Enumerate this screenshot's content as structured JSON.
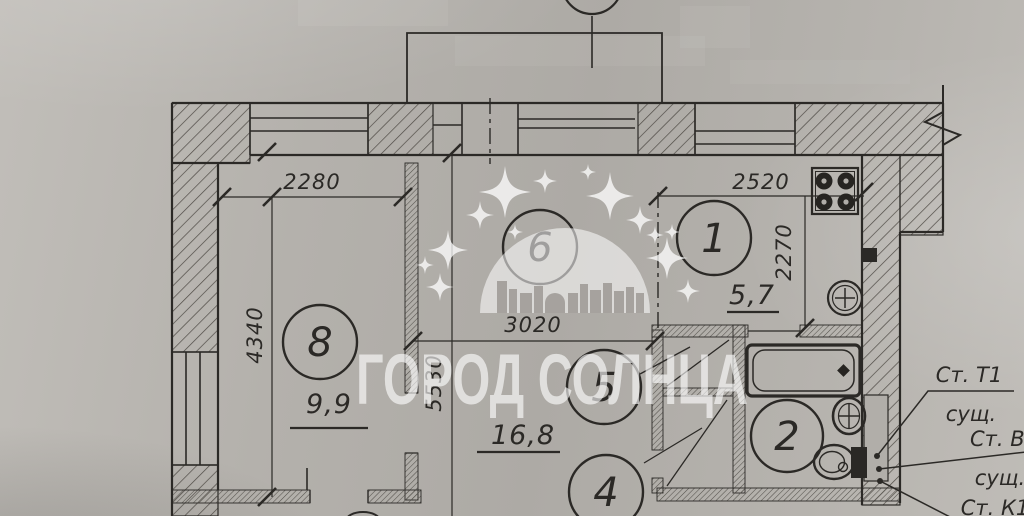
{
  "watermark": {
    "text": "ГОРОД СОЛНЦА"
  },
  "rooms": {
    "r1": "1",
    "r2": "2",
    "r4": "4",
    "r5": "5",
    "r6": "6",
    "r8": "8"
  },
  "areas": {
    "kitchen": "5,7",
    "room8": "9,9",
    "living": "16,8"
  },
  "dims": {
    "w2280": "2280",
    "w2520": "2520",
    "w3020": "3020",
    "h4340": "4340",
    "h5530": "5530",
    "h2270": "2270"
  },
  "risers": [
    {
      "label": "Ст. Т1",
      "note": "сущ."
    },
    {
      "label": "Ст. В1",
      "note": "сущ."
    },
    {
      "label": "Ст. К1",
      "note": ""
    }
  ],
  "colors": {
    "paper": "#b2afaa",
    "ink": "#2b2926",
    "watermark": "#ffffff"
  }
}
